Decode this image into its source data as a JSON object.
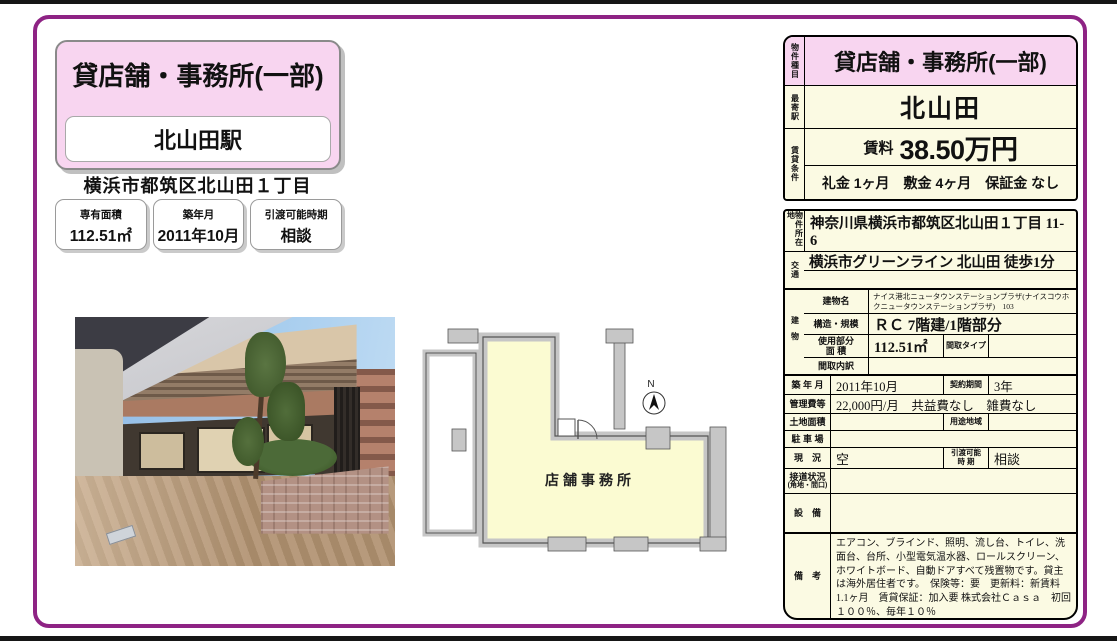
{
  "colors": {
    "accent_pink": "#f8d5f0",
    "cream": "#fbfae3",
    "frame_purple": "#8e2384"
  },
  "header": {
    "property_type": "貸店舗・事務所(一部)",
    "station": "北山田駅",
    "address": "横浜市都筑区北山田１丁目",
    "stats": [
      {
        "label": "専有面積",
        "value": "112.51㎡"
      },
      {
        "label": "築年月",
        "value": "2011年10月"
      },
      {
        "label": "引渡可能時期",
        "value": "相談"
      }
    ]
  },
  "summary": {
    "type_label": "物件種目",
    "type_value": "貸店舗・事務所(一部)",
    "station_label": "最寄駅",
    "station_value": "北山田",
    "terms_label": "賃貸条件",
    "rent_label": "賃料",
    "rent_value": "38.50万円",
    "terms_value": "礼金 1ヶ月　敷金 4ヶ月　保証金 なし"
  },
  "details": {
    "location_label": "物件所在地",
    "location": "神奈川県横浜市都筑区北山田１丁目 11-6",
    "access_label": "交通",
    "access_line1": "横浜市グリーンライン 北山田 徒歩1分",
    "access_line2": "",
    "building_label": "建物",
    "building_name_label": "建物名",
    "building_name": "ナイス港北ニュータウンステーションプラザ(ナイスコウホクニュータウンステーションプラザ)　103",
    "structure_label": "構造・規模",
    "structure": "ＲＣ 7階建/1階部分",
    "area_label_1": "使用部分",
    "area_label_2": "面 積",
    "area": "112.51㎡",
    "layout_type_label": "間取タイプ",
    "layout_type": "",
    "layout_detail_label": "間取内訳",
    "layout_detail": "",
    "built_label": "築 年 月",
    "built": "2011年10月",
    "contract_label": "契約期間",
    "contract": "3年",
    "fees_label": "管理費等",
    "fees": "22,000円/月　共益費なし　雑費なし",
    "land_label": "土地面積",
    "land": "",
    "zoning_label": "用途地域",
    "zoning": "",
    "parking_label": "駐 車 場",
    "parking": "",
    "status_label": "現　況",
    "status": "空",
    "handover_label_1": "引渡可能",
    "handover_label_2": "時 期",
    "handover": "相談",
    "road_label_1": "接道状況",
    "road_label_2": "(角地・間口)",
    "road": "",
    "equipment_label": "設　備",
    "equipment": "",
    "remarks_label": "備　考",
    "remarks": "エアコン、ブラインド、照明、流し台、トイレ、洗面台、台所、小型電気温水器、ロールスクリーン、ホワイトボード、自動ドアすべて残置物です。貸主は海外居住者です。　保険等：要　更新料：新賃料1.1ヶ月　賃貸保証：加入要 株式会社Ｃａｓａ　初回１００％、毎年１０％"
  },
  "floorplan": {
    "room_label": "店舗事務所",
    "compass_label": "N"
  }
}
